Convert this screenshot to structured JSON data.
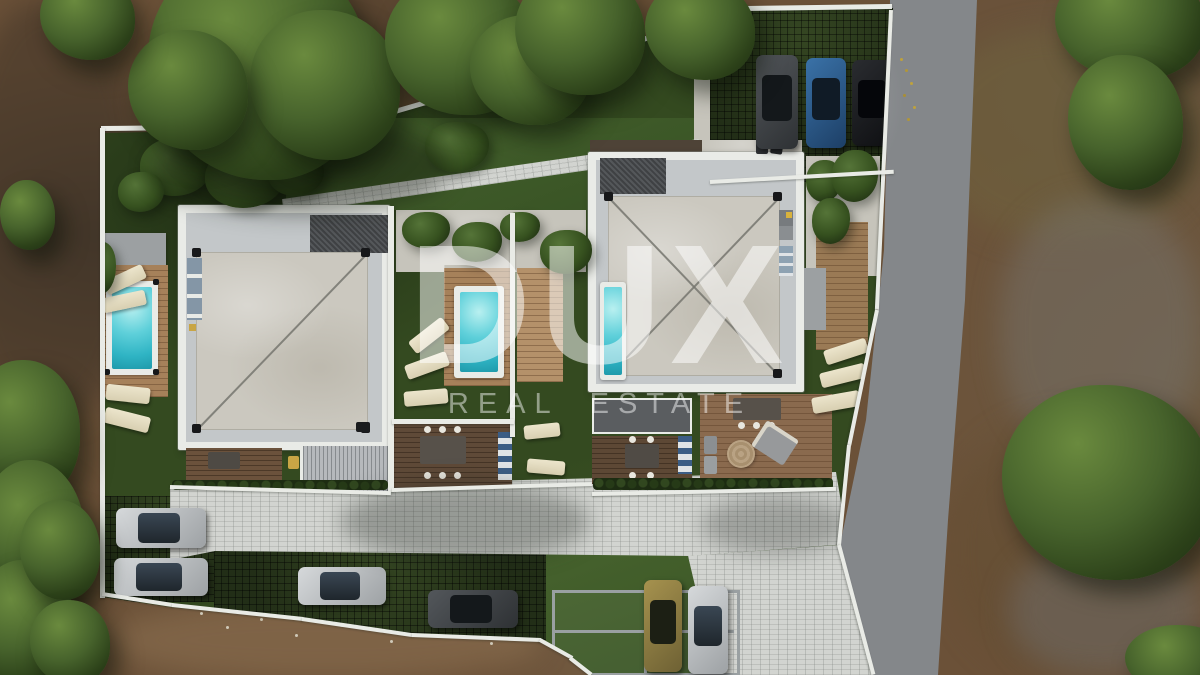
{
  "type": "real-estate-aerial-render",
  "watermark": {
    "brand": "DUX",
    "tagline": "REAL ESTATE"
  },
  "scene": {
    "setting": "top-down aerial 3D architectural render of a two-villa residential plot",
    "buildings": [
      {
        "name": "villa-left",
        "roof": "flat concrete slab, white parapet, single diagonal seam, black corner drains"
      },
      {
        "name": "villa-right",
        "roof": "flat concrete slab, white parapet, X diagonal seams, black corner drains"
      }
    ],
    "pools": [
      {
        "name": "pool-left-garden"
      },
      {
        "name": "pool-center-courtyard"
      },
      {
        "name": "lap-pool-right-villa"
      }
    ],
    "parked_cars": [
      {
        "area": "top-right-grass-grid",
        "colors": [
          "dark-gray",
          "blue",
          "black"
        ]
      },
      {
        "area": "bottom-left-grass-grid",
        "colors": [
          "silver",
          "silver"
        ]
      },
      {
        "area": "bottom-center-strip",
        "colors": [
          "silver",
          "dark-gray"
        ]
      },
      {
        "area": "bottom-right-carport",
        "colors": [
          "gold",
          "silver"
        ]
      }
    ],
    "palette": {
      "dirt": "#6b5138",
      "lawn": "#344a20",
      "grid_grass": "#222e17",
      "pavers": "#d2d4d0",
      "road": "#84878a",
      "wall_white": "#e9ebe7",
      "roof_slab": "#cbc8bf",
      "wood_deck": "#a6815a",
      "pool_water": "#49c5d6",
      "tree_canopy": "#3c5523",
      "watermark": "rgba(255,255,255,0.5)"
    }
  }
}
